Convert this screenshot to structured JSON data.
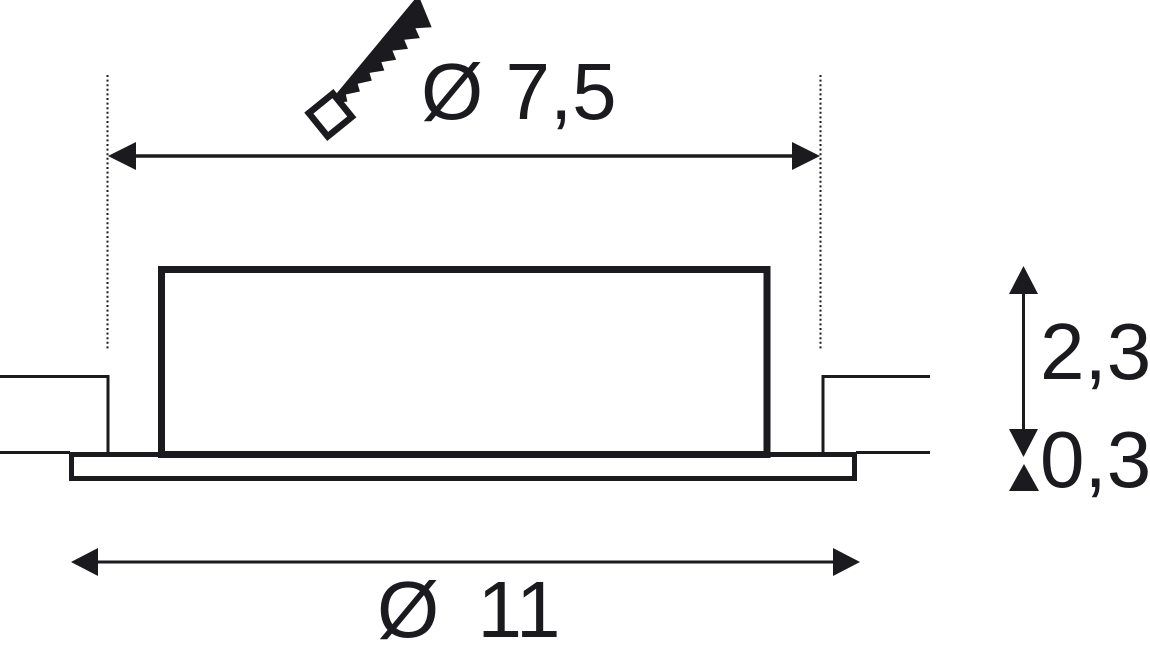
{
  "diagram": {
    "kind": "technical dimension drawing of a recessed ceiling luminaire (side profile)",
    "background_color": "#ffffff",
    "ink_color": "#1a1a1f"
  },
  "dimensions": {
    "cutout_diameter": {
      "label": "Ø 7,5"
    },
    "housing_height": {
      "label": "2,3"
    },
    "flange_thickness": {
      "label": "0,3"
    },
    "outer_diameter": {
      "label": "Ø 11"
    }
  },
  "icons": [
    {
      "name": "saw-icon"
    }
  ]
}
